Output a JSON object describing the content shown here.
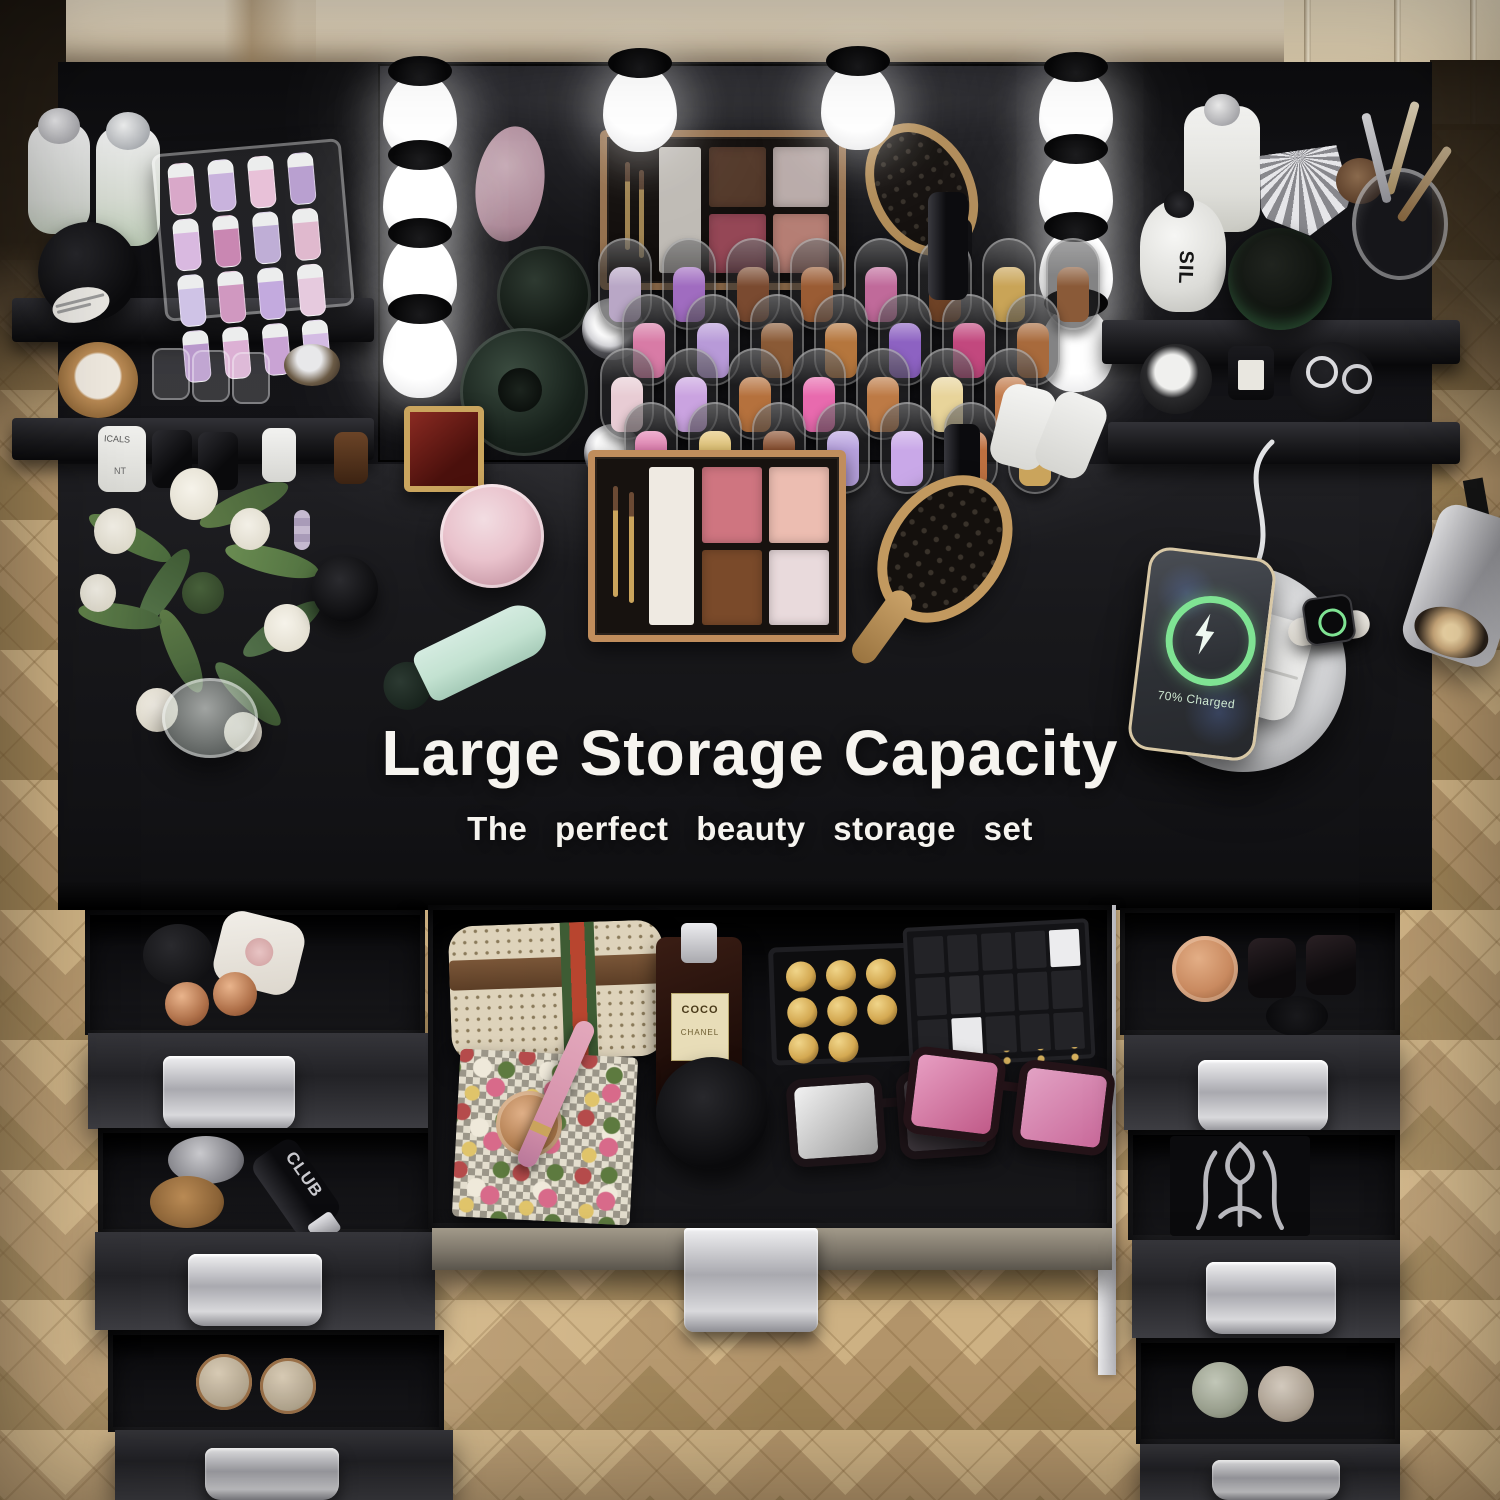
{
  "meta": {
    "type": "product-photo",
    "subject": "Top-down view of a black LED-lighted makeup vanity desk with shelves and open storage drawers on a herringbone wood floor"
  },
  "overlay": {
    "heading": "Large Storage Capacity",
    "subheading": "The perfect beauty storage set"
  },
  "labels": {
    "phone_status": "70% Charged",
    "perfume_name": "COCO",
    "perfume_brand": "CHANEL",
    "sil_bottle": "SIL",
    "club_bottle": "CLUB",
    "white_cylinder_line1": "ICALS",
    "white_cylinder_line2": "NT"
  },
  "colors": {
    "wood": "#b2946a",
    "wood_light": "#cdb183",
    "wood_dark": "#9b8054",
    "wall": "#ece0c9",
    "desk": "#17171a",
    "silver": "#cfcfd3",
    "gold": "#c9a255",
    "accent_green": "#7fe393",
    "pink": "#e9c2cc",
    "mint": "#c3e2d1",
    "bag_beige": "#ded3bb",
    "stripe_red": "#b8452f",
    "stripe_green": "#3e5c34"
  },
  "palette": {
    "pans": [
      "#cf7580",
      "#ecbdb1",
      "#7a4a2a",
      "#e9dadc"
    ],
    "pans_reflection": [
      "#6b4632",
      "#e9d5d2",
      "#c2566b",
      "#e99c8e"
    ]
  },
  "lipsticks": {
    "rack1_back": [
      "#b9a7c6",
      "#a06cc0",
      "#7a4a30",
      "#9a5c34",
      "#c06a9a",
      "#6e4226",
      "#c9a457",
      "#8a5a38"
    ],
    "rack1_front": [
      "#d87ba6",
      "#b89ad8",
      "#8a5a36",
      "#b5763d",
      "#8d62c2",
      "#c2487e",
      "#a86a3c"
    ],
    "rack2_back": [
      "#e8ccd4",
      "#caa3e0",
      "#b5713d",
      "#e86aae",
      "#bd7a45",
      "#e8d49a",
      "#c27a4a"
    ],
    "rack2_front": [
      "#e381b2",
      "#e3c474",
      "#8a4f2e",
      "#b9a3e0",
      "#c9a8e8",
      "#bd7040",
      "#caa45c"
    ]
  },
  "lipgloss_organizer": {
    "tubes": [
      "#d9a8c9",
      "#c9b3dd",
      "#e8c1d8",
      "#b9a0d0",
      "#d9b9e0",
      "#c987b2",
      "#bfaed6",
      "#e0b9ce",
      "#cfc3e6",
      "#d098c0",
      "#c3aade",
      "#e6cade",
      "#b998cc",
      "#dcb0d4",
      "#c9a3d4",
      "#d4bce4"
    ]
  },
  "gold_tray": {
    "bullets": [
      "#d4a952",
      "#d4a952",
      "#d4a952",
      "#d4a952",
      "#d4a952",
      "#d4a952",
      "#d4a952",
      "#d4a952"
    ]
  },
  "giftbox": {
    "cells": [
      "#232327",
      "#232327",
      "#232327",
      "#232327",
      "#ececee",
      "#232327",
      "#2a2a2e",
      "#232327",
      "#232327",
      "#232327",
      "#232327",
      "#e9e9eb",
      "#232327",
      "#232327",
      "#232327"
    ]
  }
}
